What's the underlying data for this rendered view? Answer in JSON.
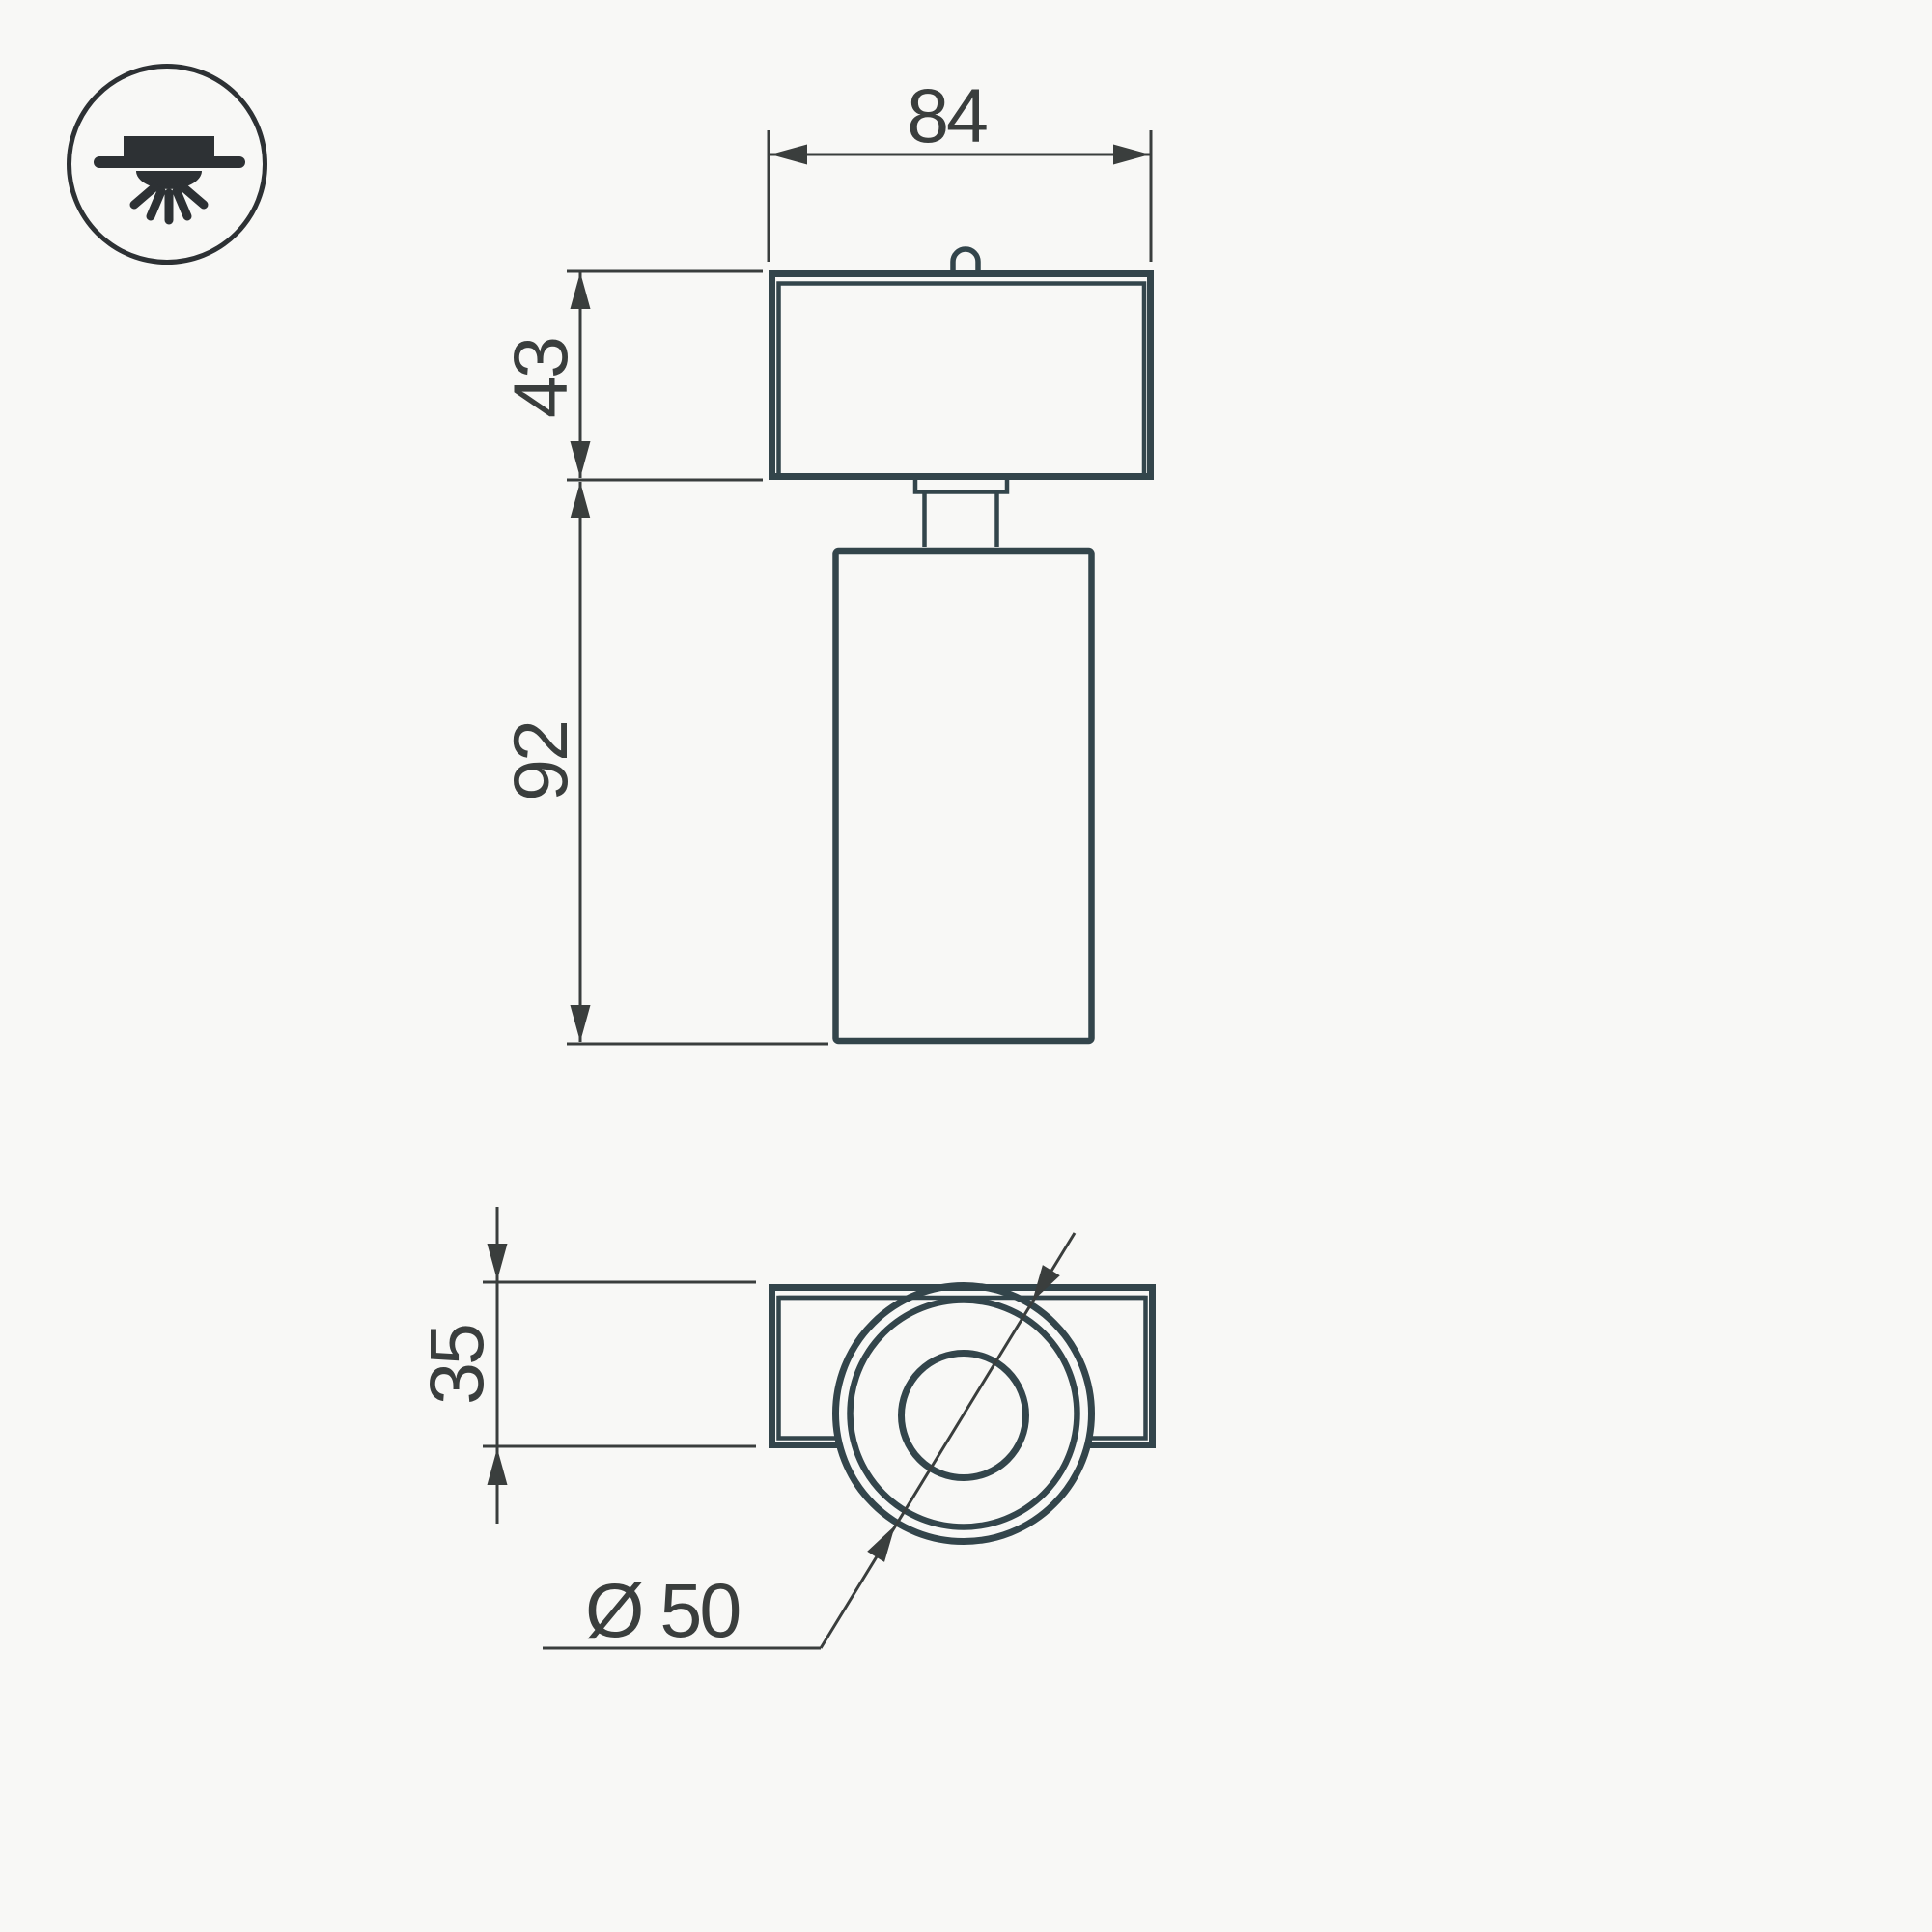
{
  "page": {
    "background": "#f8f8f6"
  },
  "colors": {
    "outline": "#33454b",
    "dimension": "#3a3e3d",
    "icon": "#2d3134"
  },
  "icon": {
    "name": "surface-mounted-downlight-icon"
  },
  "views": {
    "front": {
      "name": "front-view",
      "dimensions": {
        "width": "84",
        "head_height": "43",
        "body_height": "92"
      }
    },
    "top": {
      "name": "top-view",
      "dimensions": {
        "bracket_depth": "35",
        "diameter": "Ø 50"
      }
    }
  }
}
